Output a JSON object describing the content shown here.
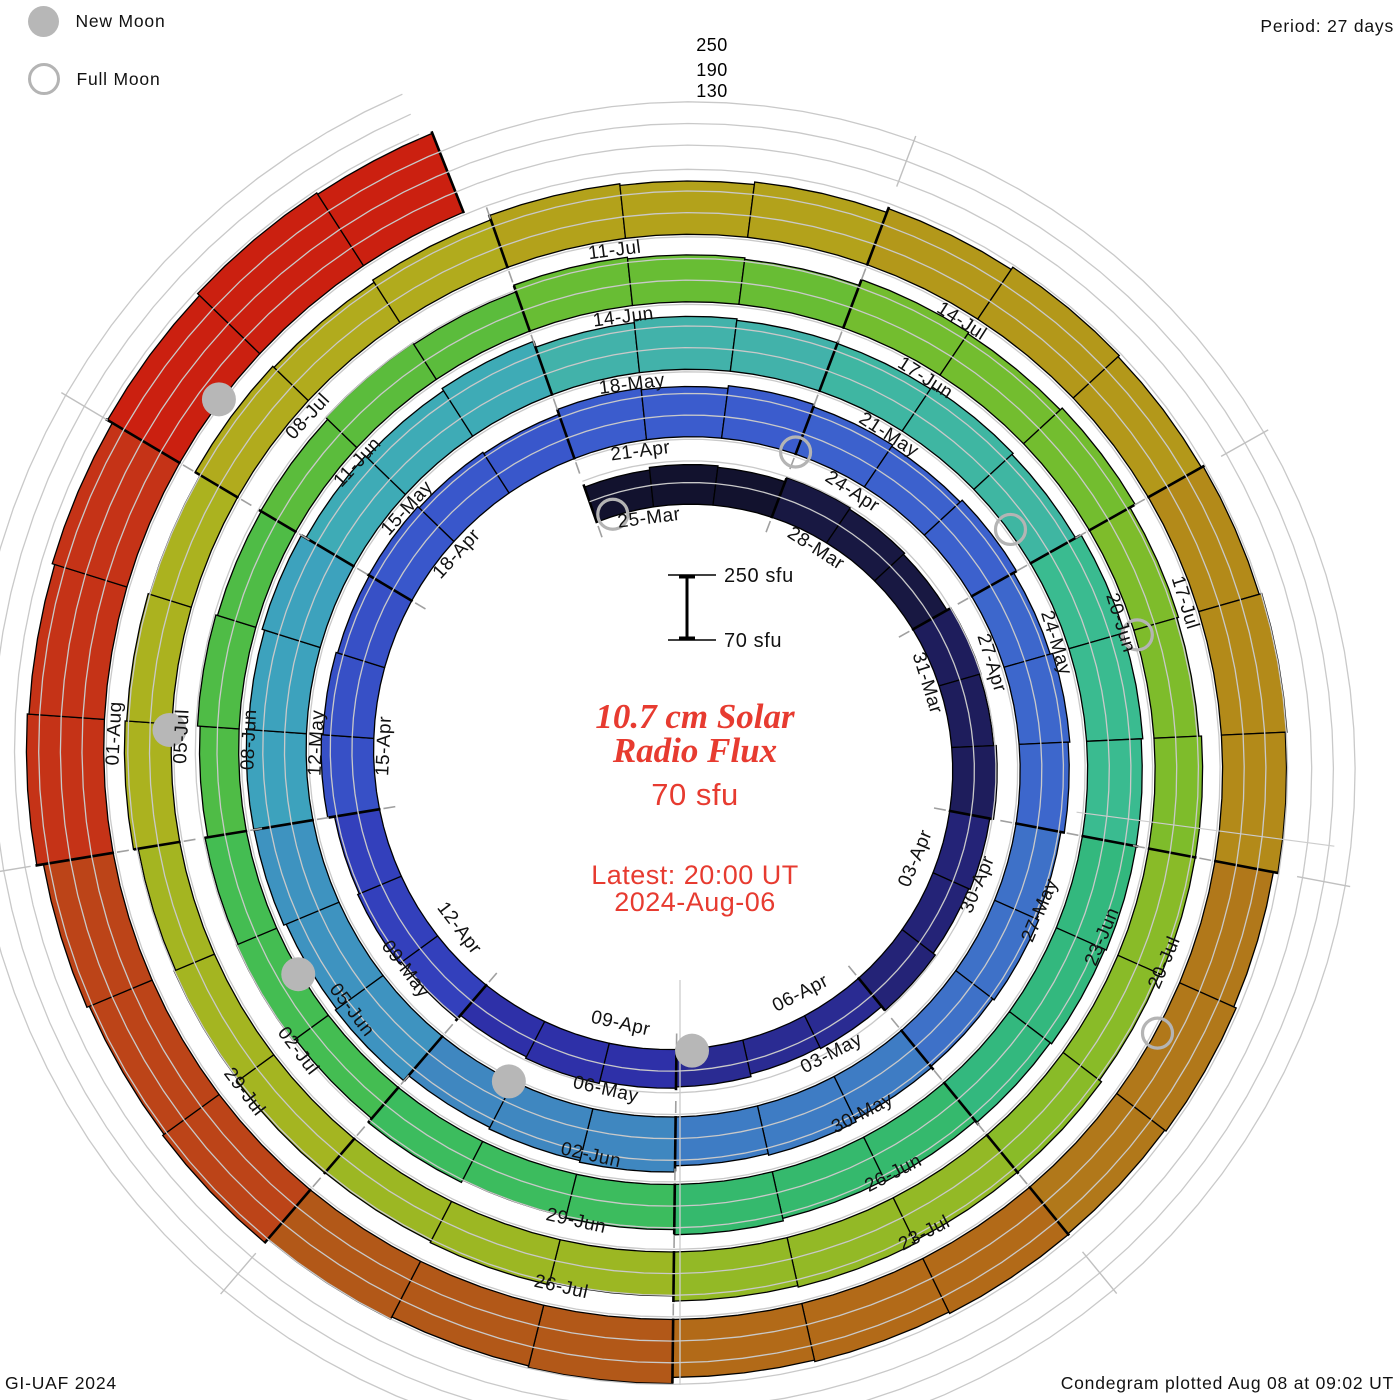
{
  "header": {
    "period_label": "Period: 27 days"
  },
  "legend": {
    "new_moon_label": "New Moon",
    "full_moon_label": "Full Moon"
  },
  "footer": {
    "left": "GI-UAF 2024",
    "right": "Condegram plotted Aug 08 at 09:02 UT"
  },
  "center": {
    "title_line1": "10.7 cm Solar",
    "title_line2": "Radio Flux",
    "current_value": "70 sfu",
    "latest_line1": "Latest: 20:00 UT",
    "latest_line2": "2024-Aug-06"
  },
  "scale_bar": {
    "top": "250 sfu",
    "bottom": "70 sfu"
  },
  "radial_axis": {
    "labels": [
      "250",
      "190",
      "130"
    ]
  },
  "colors": {
    "accent_red": "#e73b30",
    "moon_new_fill": "#b7b7b7",
    "moon_full_stroke": "#b4b4b4",
    "grid_gray": "#c9c9c9",
    "tick_gray": "#a0a0a0",
    "label_black": "#111111"
  },
  "chart_data": {
    "type": "spiral-bar-condegram",
    "title": "10.7 cm Solar Radio Flux",
    "units": "sfu",
    "period_days": 27,
    "start_date": "2024-03-25",
    "end_date_label": "2024-Aug-06",
    "latest_time": "20:00 UT",
    "sfu_baseline": 70,
    "gridline_levels_sfu": [
      130,
      190,
      250
    ],
    "end_day": 134.83,
    "groups": [
      {
        "date": "25-Mar",
        "flux": 178,
        "color": "#12122e",
        "show_label": true
      },
      {
        "date": "28-Mar",
        "flux": 183,
        "color": "#181842",
        "show_label": true
      },
      {
        "date": "31-Mar",
        "flux": 188,
        "color": "#1e1d5c",
        "show_label": true
      },
      {
        "date": "03-Apr",
        "flux": 182,
        "color": "#242377",
        "show_label": true
      },
      {
        "date": "06-Apr",
        "flux": 172,
        "color": "#2a2b92",
        "show_label": true
      },
      {
        "date": "09-Apr",
        "flux": 180,
        "color": "#2e30a8",
        "show_label": true
      },
      {
        "date": "12-Apr",
        "flux": 198,
        "color": "#3340bc",
        "show_label": true
      },
      {
        "date": "15-Apr",
        "flux": 210,
        "color": "#3750c6",
        "show_label": true
      },
      {
        "date": "18-Apr",
        "flux": 205,
        "color": "#3957cb",
        "show_label": true
      },
      {
        "date": "21-Apr",
        "flux": 212,
        "color": "#3b5ccd",
        "show_label": true
      },
      {
        "date": "24-Apr",
        "flux": 210,
        "color": "#3c61cd",
        "show_label": true
      },
      {
        "date": "27-Apr",
        "flux": 205,
        "color": "#3d67cc",
        "show_label": true
      },
      {
        "date": "30-Apr",
        "flux": 200,
        "color": "#3e71c8",
        "show_label": true
      },
      {
        "date": "03-May",
        "flux": 208,
        "color": "#3e7cc4",
        "show_label": true
      },
      {
        "date": "06-May",
        "flux": 218,
        "color": "#3f87c0",
        "show_label": true
      },
      {
        "date": "09-May",
        "flux": 230,
        "color": "#3e93c0",
        "show_label": true
      },
      {
        "date": "12-May",
        "flux": 235,
        "color": "#3da2bd",
        "show_label": true
      },
      {
        "date": "15-May",
        "flux": 225,
        "color": "#3eabb6",
        "show_label": true
      },
      {
        "date": "18-May",
        "flux": 212,
        "color": "#42b2aa",
        "show_label": true
      },
      {
        "date": "21-May",
        "flux": 215,
        "color": "#3fb6a2",
        "show_label": true
      },
      {
        "date": "24-May",
        "flux": 225,
        "color": "#3abb90",
        "show_label": true
      },
      {
        "date": "27-May",
        "flux": 218,
        "color": "#33b87e",
        "show_label": true
      },
      {
        "date": "30-May",
        "flux": 205,
        "color": "#35b96d",
        "show_label": true
      },
      {
        "date": "02-Jun",
        "flux": 195,
        "color": "#3cbc5e",
        "show_label": true
      },
      {
        "date": "05-Jun",
        "flux": 185,
        "color": "#44bd52",
        "show_label": true
      },
      {
        "date": "08-Jun",
        "flux": 182,
        "color": "#4fbc46",
        "show_label": true
      },
      {
        "date": "11-Jun",
        "flux": 188,
        "color": "#5bbc3c",
        "show_label": true
      },
      {
        "date": "14-Jun",
        "flux": 200,
        "color": "#68bd34",
        "show_label": true
      },
      {
        "date": "17-Jun",
        "flux": 210,
        "color": "#73bd2f",
        "show_label": true
      },
      {
        "date": "20-Jun",
        "flux": 198,
        "color": "#7ebc2b",
        "show_label": true
      },
      {
        "date": "23-Jun",
        "flux": 202,
        "color": "#89bb28",
        "show_label": true
      },
      {
        "date": "26-Jun",
        "flux": 206,
        "color": "#93b926",
        "show_label": true
      },
      {
        "date": "29-Jun",
        "flux": 196,
        "color": "#9cb723",
        "show_label": true
      },
      {
        "date": "02-Jul",
        "flux": 190,
        "color": "#a4b521",
        "show_label": true
      },
      {
        "date": "05-Jul",
        "flux": 196,
        "color": "#abb21f",
        "show_label": true
      },
      {
        "date": "08-Jul",
        "flux": 205,
        "color": "#b1ab1d",
        "show_label": true
      },
      {
        "date": "11-Jul",
        "flux": 222,
        "color": "#b3a21b",
        "show_label": true
      },
      {
        "date": "14-Jul",
        "flux": 238,
        "color": "#b3981a",
        "show_label": true
      },
      {
        "date": "17-Jul",
        "flux": 248,
        "color": "#b38a19",
        "show_label": true
      },
      {
        "date": "20-Jul",
        "flux": 240,
        "color": "#b1781a",
        "show_label": true
      },
      {
        "date": "23-Jul",
        "flux": 235,
        "color": "#b26a18",
        "show_label": true
      },
      {
        "date": "26-Jul",
        "flux": 245,
        "color": "#b25818",
        "show_label": true
      },
      {
        "date": "29-Jul",
        "flux": 262,
        "color": "#bc4418",
        "show_label": true
      },
      {
        "date": "01-Aug",
        "flux": 285,
        "color": "#c53317",
        "show_label": true
      },
      {
        "date": "04-Aug",
        "flux": 305,
        "color": "#cb2010",
        "show_label": false
      }
    ],
    "moons": {
      "full": [
        {
          "date": "25-Mar",
          "day": 0.3
        },
        {
          "date": "23-Apr",
          "day": 29.99
        },
        {
          "date": "23-May",
          "day": 59.58
        },
        {
          "date": "21-Jun",
          "day": 88.05
        },
        {
          "date": "21-Jul",
          "day": 118.43
        }
      ],
      "new": [
        {
          "date": "08-Apr",
          "day": 14.77
        },
        {
          "date": "08-May",
          "day": 44.05
        },
        {
          "date": "06-Jun",
          "day": 73.5
        },
        {
          "date": "05-Jul",
          "day": 102.95
        },
        {
          "date": "04-Aug",
          "day": 132.55
        }
      ]
    }
  }
}
